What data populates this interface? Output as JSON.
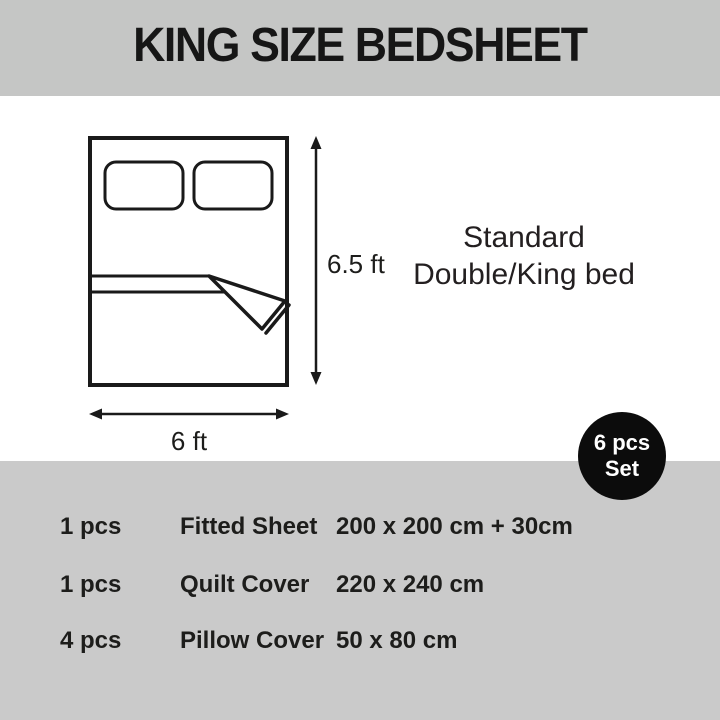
{
  "header": {
    "title": "KING SIZE BEDSHEET"
  },
  "diagram": {
    "height_label": "6.5 ft",
    "width_label": "6 ft",
    "caption_line1": "Standard",
    "caption_line2": "Double/King bed"
  },
  "badge": {
    "line1": "6 pcs",
    "line2": "Set"
  },
  "set_table": {
    "rows": [
      {
        "qty": "1 pcs",
        "item": "Fitted Sheet",
        "size": "200 x 200 cm + 30cm"
      },
      {
        "qty": "1 pcs",
        "item": "Quilt Cover",
        "size": "220 x 240 cm"
      },
      {
        "qty": "4 pcs",
        "item": "Pillow Cover",
        "size": "50 x 80 cm"
      }
    ]
  },
  "colors": {
    "banner_gray": "#c5c6c5",
    "bottom_gray": "#cacaca",
    "ink": "#1d1d1b",
    "badge_black": "#0c0c0c"
  }
}
